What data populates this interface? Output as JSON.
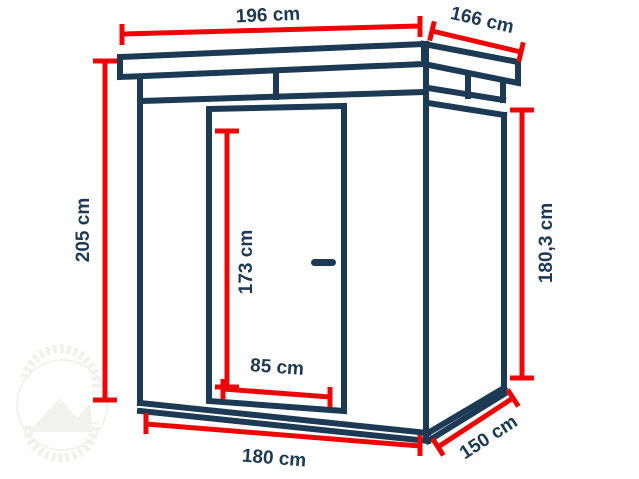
{
  "colors": {
    "navy": "#1c3a54",
    "red": "#ee0606",
    "watermark": "#f1f1ee",
    "background": "#ffffff"
  },
  "diagram": {
    "subject": "flat-roof garden shed line drawing with dimension callouts",
    "dimensions": {
      "roof_width": "196 cm",
      "roof_depth": "166 cm",
      "height_front": "205 cm",
      "height_back": "180,3 cm",
      "door_height": "173 cm",
      "door_width": "85 cm",
      "base_width": "180 cm",
      "base_depth": "150 cm"
    }
  }
}
